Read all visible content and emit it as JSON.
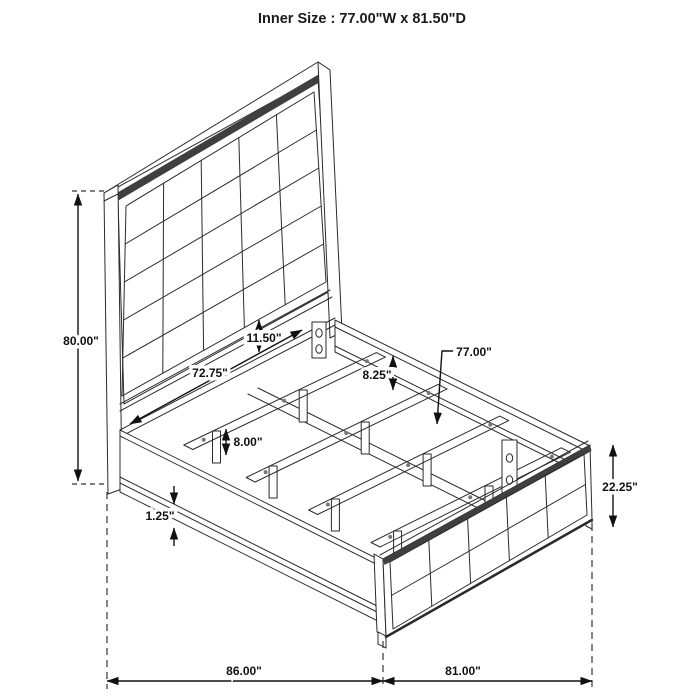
{
  "title": "Inner Size : 77.00\"W x 81.50\"D",
  "diagram_type": "isometric bed frame dimension drawing",
  "annotations": {
    "headboard_height": "80.00\"",
    "panel_to_rail_gap": "11.50\"",
    "headboard_inner_width": "72.75\"",
    "rail_top_to_slat": "8.25\"",
    "slat_length": "77.00\"",
    "slat_leg_height": "8.00\"",
    "rail_trim_height": "1.25\"",
    "footboard_height": "22.25\"",
    "overall_length": "86.00\"",
    "overall_width": "81.00\""
  },
  "colors": {
    "line": "#2b2b2b",
    "dimension": "#111111",
    "shade_band": "#3f3f3f",
    "background": "#ffffff"
  }
}
